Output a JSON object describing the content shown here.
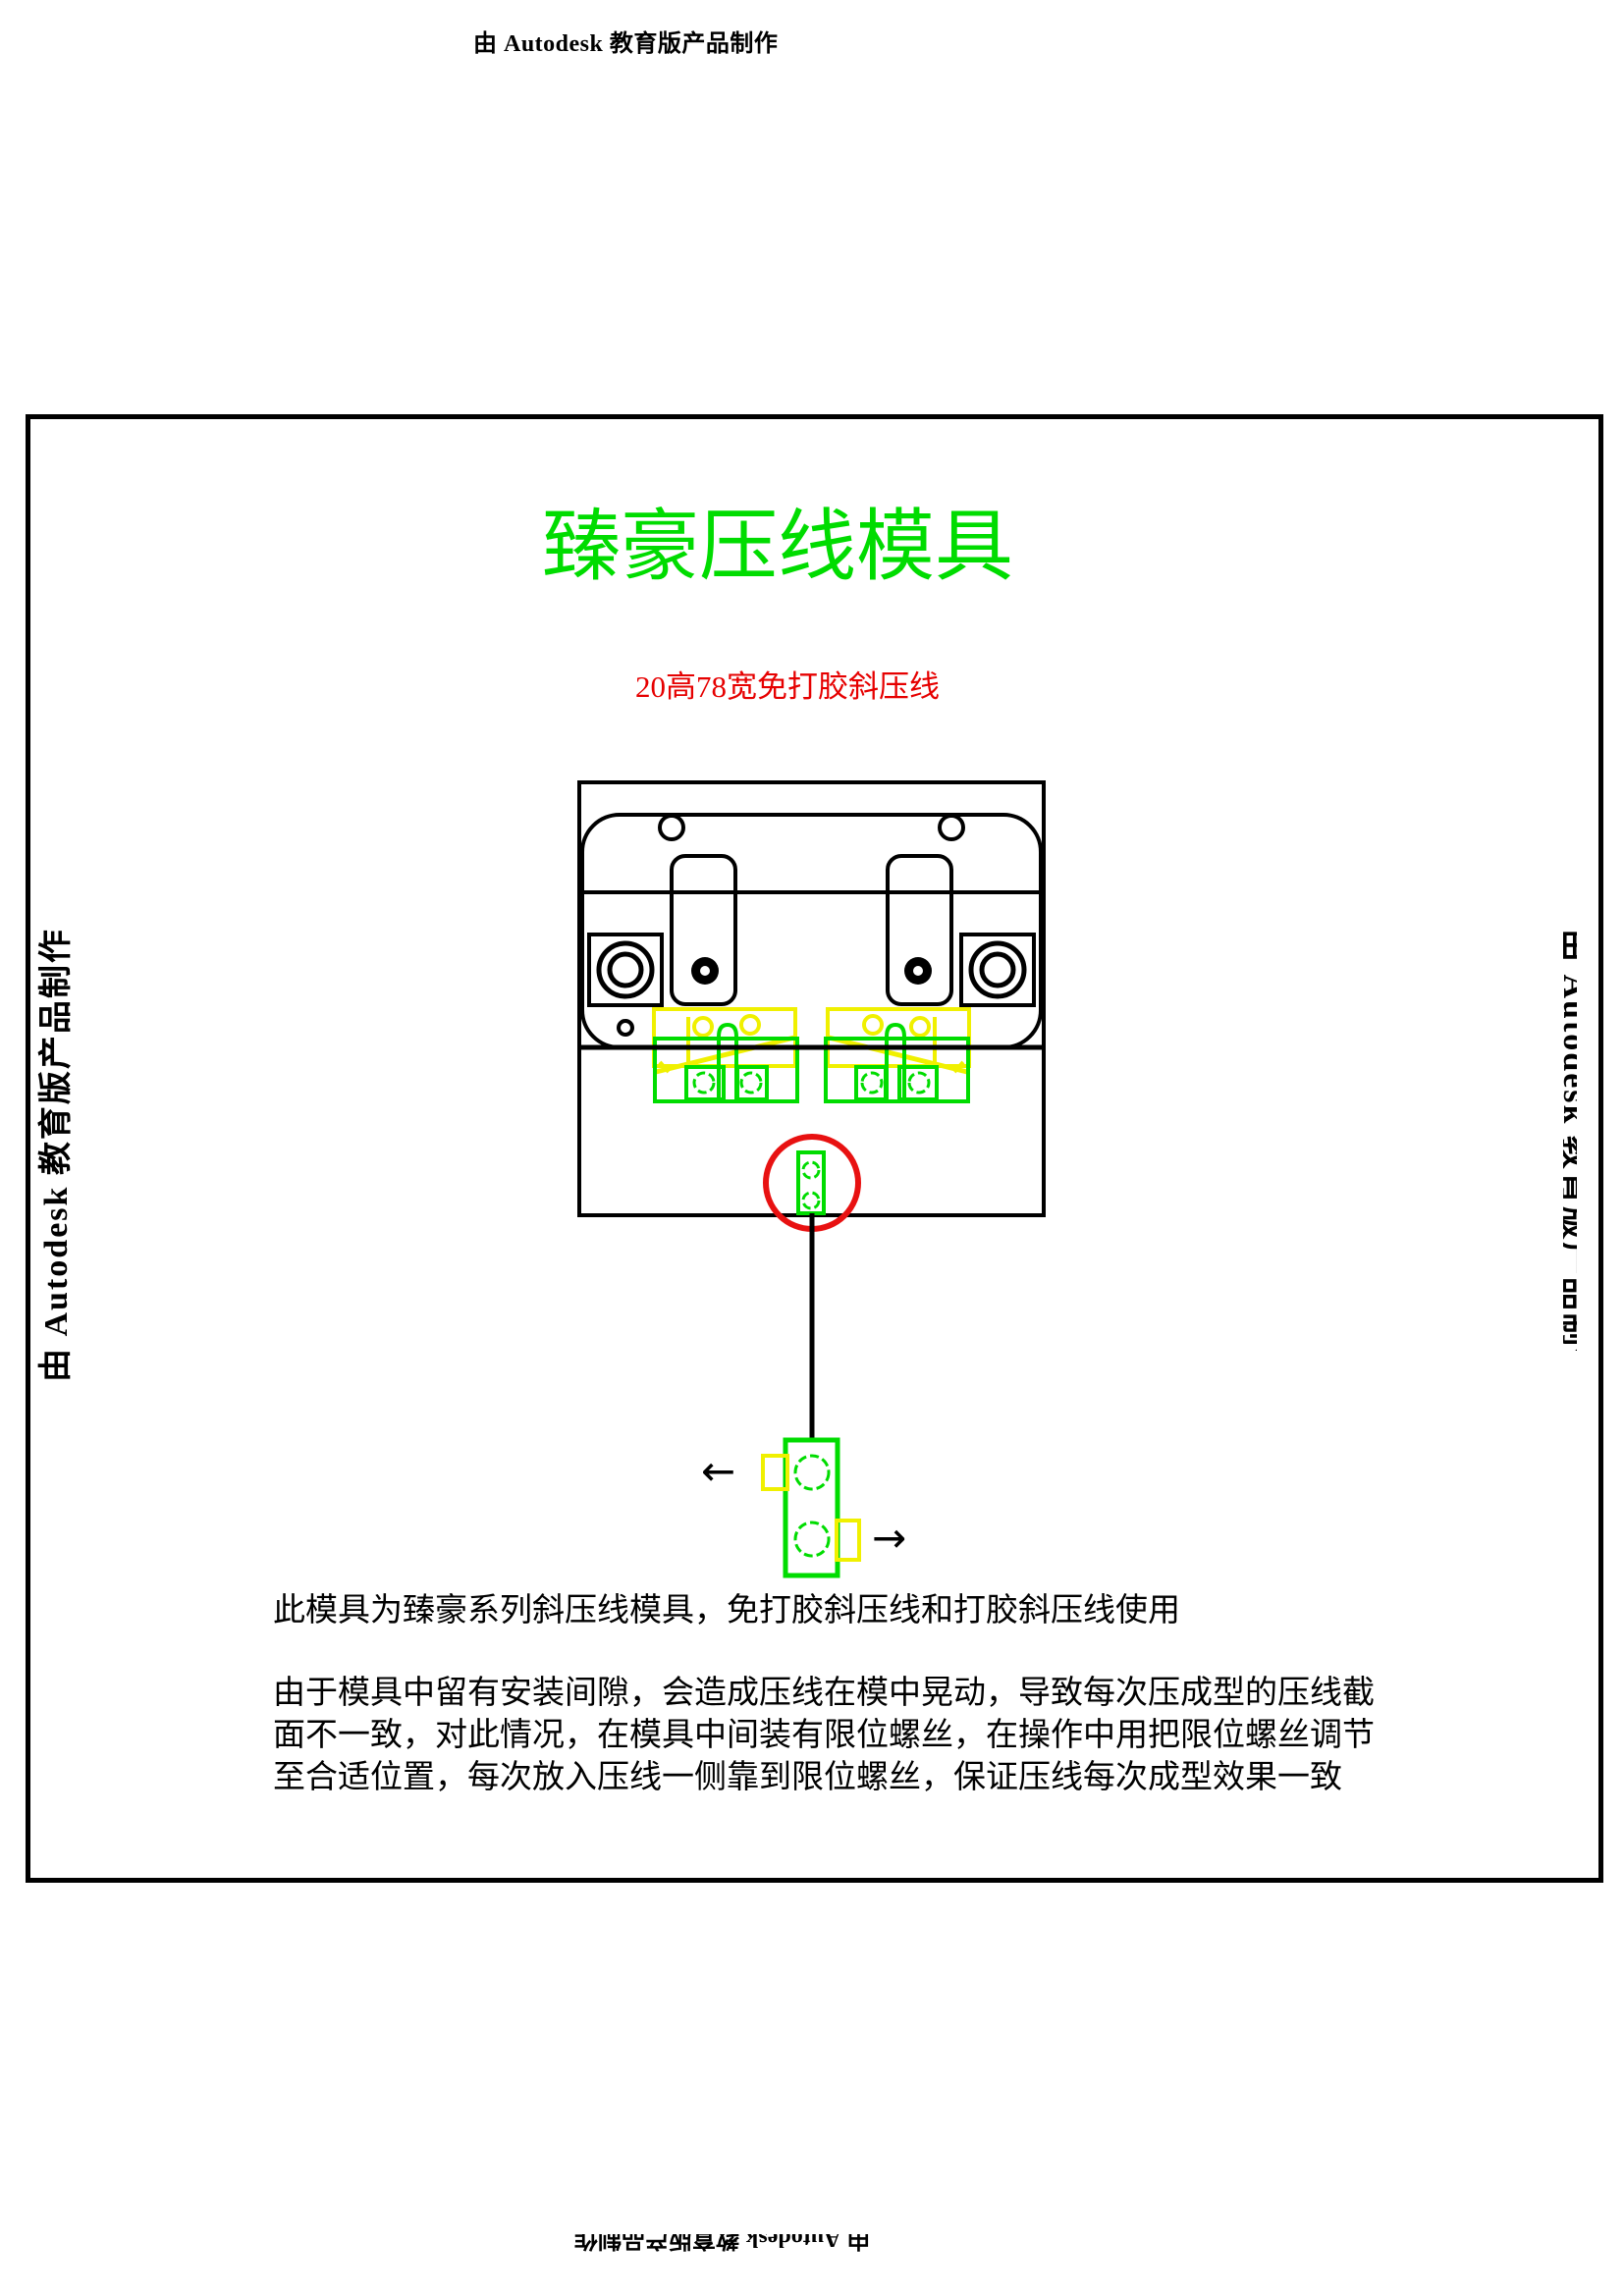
{
  "watermarks": {
    "top": "由 Autodesk 教育版产品制作",
    "left": "由 Autodesk 教育版产品制作",
    "right": "由 Autodesk 教育版产品制作",
    "bottom": "由 Autodesk 教育版产品制作"
  },
  "header": {
    "title": "臻豪压线模具",
    "subtitle": "20高78宽免打胶斜压线"
  },
  "notes": {
    "paragraph1": "此模具为臻豪系列斜压线模具，免打胶斜压线和打胶斜压线使用",
    "paragraph2_line1": "由于模具中留有安装间隙，会造成压线在模中晃动，导致每次压成型的压线截",
    "paragraph2_line2": "面不一致，对此情况，在模具中间装有限位螺丝，在操作中用把限位螺丝调节",
    "paragraph2_line3": "至合适位置，每次放入压线一侧靠到限位螺丝，保证压线每次成型效果一致"
  },
  "detail_view": {
    "left_arrow": "←",
    "right_arrow": "→"
  },
  "colors": {
    "cad_green": "#00dc00",
    "cad_yellow": "#f0f000",
    "cad_red": "#e81111",
    "title_green": "#00dc00",
    "subtitle_red": "#e60000"
  }
}
